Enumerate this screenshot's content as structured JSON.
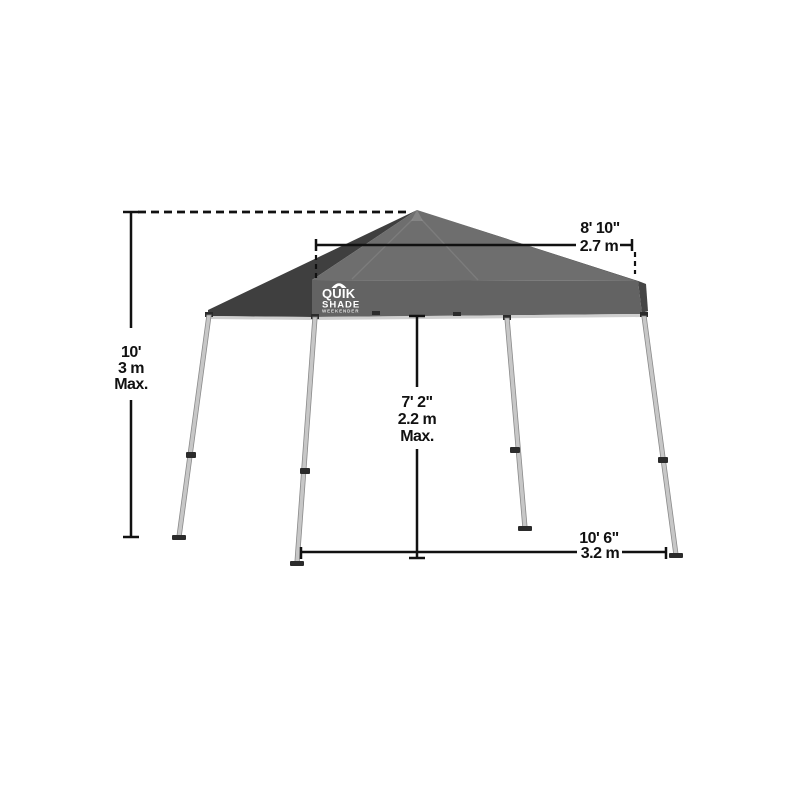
{
  "tent": {
    "brand": {
      "name_line1": "QUIK",
      "name_line2": "SHADE",
      "tagline": "WEEKENDER"
    },
    "colors": {
      "roof_left": "#3f3f3f",
      "roof_front": "#6e6e6e",
      "roof_right": "#4a4a4a",
      "valance_front": "#636363",
      "valance_right": "#454545",
      "eave_trim": "#cfcfcf",
      "leg": "#c7c7c7",
      "hardware": "#2b2b2b",
      "dimension_line": "#111111"
    }
  },
  "dimensions": {
    "total_height": {
      "imperial": "10'",
      "metric": "3 m",
      "qualifier": "Max."
    },
    "canopy_top_width": {
      "imperial": "8' 10\"",
      "metric": "2.7 m"
    },
    "clearance_height": {
      "imperial": "7' 2\"",
      "metric": "2.2 m",
      "qualifier": "Max."
    },
    "base_width": {
      "imperial": "10' 6\"",
      "metric": "3.2 m"
    }
  }
}
